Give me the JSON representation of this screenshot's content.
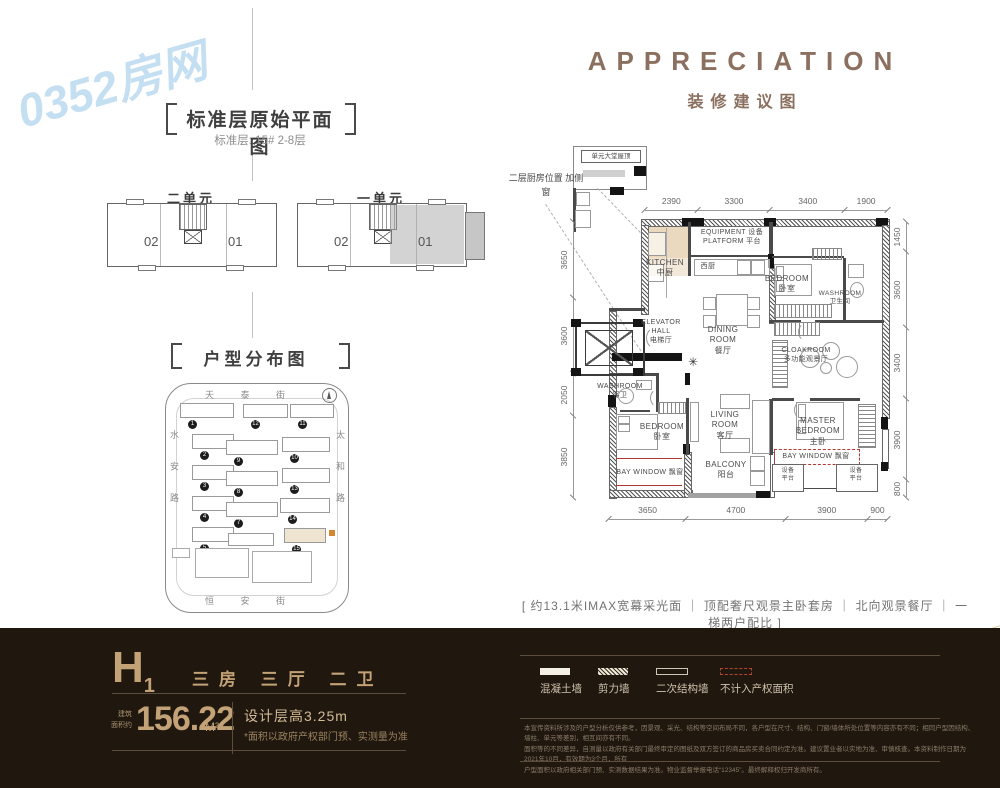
{
  "brand": {
    "watermark": "0352房网"
  },
  "left": {
    "title": "标准层原始平面图",
    "subtitle": "标准层: 15#  2-8层",
    "units": [
      {
        "label": "二单元",
        "no_left": "02",
        "no_right": "01"
      },
      {
        "label": "一单元",
        "no_left": "02",
        "no_right": "01"
      }
    ],
    "map": {
      "title": "户型分布图",
      "street_top": "天 泰 街",
      "street_bottom": "恒 安 街",
      "street_left": "水 安 路",
      "street_right": "太 和 路",
      "north": "北",
      "buildings": [
        {
          "n": "1",
          "x": 180,
          "y": 403,
          "w": 52,
          "h": 13
        },
        {
          "n": "12",
          "x": 243,
          "y": 404,
          "w": 43,
          "h": 12
        },
        {
          "n": "11",
          "x": 290,
          "y": 404,
          "w": 42,
          "h": 12
        },
        {
          "n": "2",
          "x": 192,
          "y": 434,
          "w": 40,
          "h": 13
        },
        {
          "n": "9",
          "x": 226,
          "y": 440,
          "w": 50,
          "h": 13
        },
        {
          "n": "10",
          "x": 282,
          "y": 437,
          "w": 46,
          "h": 13
        },
        {
          "n": "3",
          "x": 192,
          "y": 465,
          "w": 40,
          "h": 13
        },
        {
          "n": "8",
          "x": 226,
          "y": 471,
          "w": 50,
          "h": 13
        },
        {
          "n": "13",
          "x": 282,
          "y": 468,
          "w": 46,
          "h": 13
        },
        {
          "n": "4",
          "x": 192,
          "y": 496,
          "w": 40,
          "h": 13
        },
        {
          "n": "7",
          "x": 226,
          "y": 502,
          "w": 50,
          "h": 13
        },
        {
          "n": "14",
          "x": 280,
          "y": 498,
          "w": 48,
          "h": 13
        },
        {
          "n": "5",
          "x": 192,
          "y": 527,
          "w": 40,
          "h": 13
        },
        {
          "n": "6",
          "x": 228,
          "y": 533,
          "w": 44,
          "h": 11
        },
        {
          "n": "15",
          "x": 284,
          "y": 528,
          "w": 40,
          "h": 13,
          "hl": true
        }
      ]
    }
  },
  "plan": {
    "title": "APPRECIATION",
    "subtitle": "装修建议图",
    "note_roof": "单元大堂屋顶",
    "note_kitchen_1": "二层厨房位置",
    "note_kitchen_2": "加侧窗",
    "entry_symbol": "✳",
    "dims": {
      "top": [
        2390,
        3300,
        3400,
        1900
      ],
      "bottom": [
        3650,
        4700,
        3900,
        900
      ],
      "left": [
        3650,
        3600,
        2050,
        3850
      ],
      "right": [
        1450,
        3600,
        3400,
        3900,
        800
      ]
    },
    "rooms": {
      "equipment": [
        "EQUIPMENT 设备",
        "PLATFORM 平台"
      ],
      "kitchen": [
        "KITCHEN",
        "中厨"
      ],
      "west_kitchen": [
        "西厨"
      ],
      "bedroom_north": [
        "BEDROOM",
        "卧室"
      ],
      "washroom_north": [
        "WASHROOM",
        "卫生间"
      ],
      "elevator_hall": [
        "ELEVATOR",
        "HALL",
        "电梯厅"
      ],
      "dining": [
        "DINING ROOM",
        "餐厅"
      ],
      "cloakroom": [
        "CLOAKROOM",
        "多功能观景厅"
      ],
      "washroom_guest": [
        "WASHROOM",
        "客卫"
      ],
      "bedroom_second": [
        "BEDROOM",
        "卧室"
      ],
      "living": [
        "LIVING ROOM",
        "客厅"
      ],
      "master": [
        "MASTER BEDROOM",
        "主卧"
      ],
      "balcony": [
        "BALCONY",
        "阳台"
      ],
      "bay_window_left": [
        "BAY WINDOW 飘窗"
      ],
      "bay_window_right": [
        "BAY WINDOW 飘窗"
      ],
      "equip_small_left": [
        "设备",
        "平台"
      ],
      "equip_small_right": [
        "设备",
        "平台"
      ]
    },
    "selling_points": "[ 约13.1米IMAX宽幕采光面 ｜ 顶配奢尺观景主卧套房 ｜ 北向观景餐厅 ｜ 一梯两户配比 ]"
  },
  "footer": {
    "unit": "H",
    "unit_sub": "1",
    "layout": "三房  三厅  二卫",
    "area_label_1": "建筑",
    "area_label_2": "面积约",
    "area": "156.22",
    "area_unit": "M²",
    "floor_height": "设计层高3.25m",
    "note": "*面积以政府产权部门预、实测量为准",
    "legend": [
      {
        "label": "混凝土墙",
        "type": "solid"
      },
      {
        "label": "剪力墙",
        "type": "hatch"
      },
      {
        "label": "二次结构墙",
        "type": "outline"
      },
      {
        "label": "不计入产权面积",
        "type": "reddash"
      }
    ],
    "disclaimer": [
      "本宣传资料所涉及的户型分析仅供参考，因景观、采光、结构等空间布局不同，各户型在尺寸、结构、门窗/墙体所处位置等内容亦有不同；相同户型因结构、墙柱、单元等差别，相互间亦有不同。",
      "面积等的不同差异，自测量以政府有关部门最终审定的图纸及双方签订的商品房买卖合同约定为准。建议置业者以实地为准、审慎核查。本资料制作日期为2021年10月，有效期为3个月，所有",
      "户型面积以政府相关部门预、实测数据结果为准。物业监督举报电话“12345”。最终解释权归开发商所有。"
    ]
  }
}
